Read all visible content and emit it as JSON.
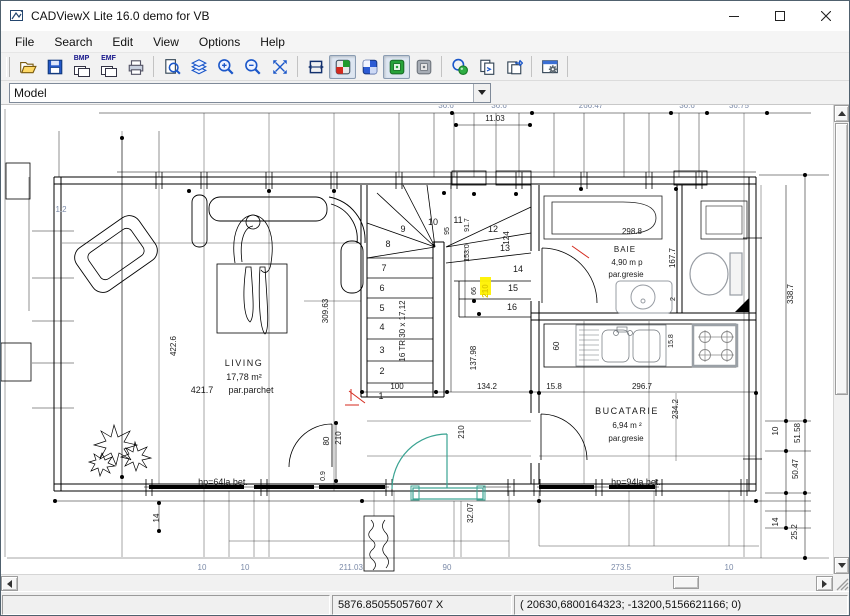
{
  "window": {
    "title": "CADViewX Lite 16.0 demo for VB"
  },
  "menu": {
    "items": [
      "File",
      "Search",
      "Edit",
      "View",
      "Options",
      "Help"
    ]
  },
  "toolbar": {
    "bmp_label": "BMP",
    "emf_label": "EMF"
  },
  "layout_combo": {
    "value": "Model"
  },
  "statusbar": {
    "cursor_x": "5876.85055057607 X",
    "coordinates": "( 20630,6800164323; -13200,5156621166; 0)"
  },
  "drawing": {
    "colors": {
      "selection_teal": "#3aa392",
      "highlight_yellow": "#fff200",
      "mark_red": "#d42a1e",
      "dim_gray_blue": "#7b8aa8"
    },
    "labels": [
      {
        "t": "LIVING",
        "x": 245,
        "y": 365,
        "s": 9,
        "sp": 1.5
      },
      {
        "t": "17,78 m²",
        "x": 245,
        "y": 379,
        "s": 9
      },
      {
        "t": "par.parchet",
        "x": 252,
        "y": 392,
        "s": 9
      },
      {
        "t": "421.7",
        "x": 203,
        "y": 392,
        "s": 9
      },
      {
        "t": "BAIE",
        "x": 626,
        "y": 251,
        "s": 8,
        "sp": 1
      },
      {
        "t": "4,90 m p",
        "x": 628,
        "y": 264,
        "s": 8
      },
      {
        "t": "par.gresie",
        "x": 627,
        "y": 276,
        "s": 8
      },
      {
        "t": "298.8",
        "x": 633,
        "y": 233,
        "s": 8
      },
      {
        "t": "BUCATARIE",
        "x": 628,
        "y": 413,
        "s": 9,
        "sp": 1.5
      },
      {
        "t": "6,94 m ²",
        "x": 628,
        "y": 427,
        "s": 8
      },
      {
        "t": "par.gresie",
        "x": 627,
        "y": 440,
        "s": 8
      },
      {
        "t": "hp=64la bet.",
        "x": 224,
        "y": 484,
        "s": 9
      },
      {
        "t": "hp=94la bet.",
        "x": 637,
        "y": 484,
        "s": 9
      },
      {
        "t": "100",
        "x": 398,
        "y": 388,
        "s": 8
      },
      {
        "t": "134.2",
        "x": 488,
        "y": 388,
        "s": 8
      },
      {
        "t": "15.8",
        "x": 555,
        "y": 388,
        "s": 8
      },
      {
        "t": "296.7",
        "x": 643,
        "y": 388,
        "s": 8
      },
      {
        "t": "11.03",
        "x": 496,
        "y": 120,
        "s": 8
      },
      {
        "t": "422.6",
        "x": 177,
        "y": 345,
        "r": 1,
        "s": 8
      },
      {
        "t": "309.63",
        "x": 329,
        "y": 310,
        "r": 1,
        "s": 8
      },
      {
        "t": "16 TR.30 x 17,12",
        "x": 406,
        "y": 330,
        "r": 1,
        "s": 8
      },
      {
        "t": "137.98",
        "x": 477,
        "y": 357,
        "r": 1,
        "s": 8
      },
      {
        "t": "66",
        "x": 477,
        "y": 290,
        "r": 1,
        "s": 7
      },
      {
        "t": "210",
        "x": 489,
        "y": 290,
        "r": 1,
        "s": 8,
        "c": "#e0cc00",
        "b": 1
      },
      {
        "t": "95",
        "x": 450,
        "y": 230,
        "r": 1,
        "s": 7
      },
      {
        "t": "91.7",
        "x": 470,
        "y": 224,
        "r": 1,
        "s": 7
      },
      {
        "t": "153.0",
        "x": 470,
        "y": 252,
        "r": 1,
        "s": 7
      },
      {
        "t": "124",
        "x": 510,
        "y": 237,
        "r": 1,
        "s": 8
      },
      {
        "t": "167.7",
        "x": 676,
        "y": 257,
        "r": 1,
        "s": 8
      },
      {
        "t": "2",
        "x": 676,
        "y": 298,
        "r": 1,
        "s": 7
      },
      {
        "t": "60",
        "x": 560,
        "y": 345,
        "r": 1,
        "s": 8
      },
      {
        "t": "15.8",
        "x": 674,
        "y": 340,
        "r": 1,
        "s": 7
      },
      {
        "t": "234.2",
        "x": 679,
        "y": 408,
        "r": 1,
        "s": 8
      },
      {
        "t": "338.7",
        "x": 794,
        "y": 293,
        "r": 1,
        "s": 8
      },
      {
        "t": "10",
        "x": 779,
        "y": 430,
        "r": 1,
        "s": 8
      },
      {
        "t": "51.58",
        "x": 801,
        "y": 432,
        "r": 1,
        "s": 8
      },
      {
        "t": "50.47",
        "x": 799,
        "y": 468,
        "r": 1,
        "s": 8
      },
      {
        "t": "14",
        "x": 779,
        "y": 521,
        "r": 1,
        "s": 8
      },
      {
        "t": "25.2",
        "x": 798,
        "y": 531,
        "r": 1,
        "s": 8
      },
      {
        "t": "80",
        "x": 330,
        "y": 440,
        "r": 1,
        "s": 8
      },
      {
        "t": "210",
        "x": 342,
        "y": 437,
        "r": 1,
        "s": 8
      },
      {
        "t": "0.9",
        "x": 326,
        "y": 475,
        "r": 1,
        "s": 7
      },
      {
        "t": "14",
        "x": 160,
        "y": 517,
        "r": 1,
        "s": 8
      },
      {
        "t": "210",
        "x": 465,
        "y": 431,
        "r": 1,
        "s": 8
      },
      {
        "t": "32.07",
        "x": 474,
        "y": 512,
        "r": 1,
        "s": 8
      },
      {
        "t": "1.2",
        "x": 62,
        "y": 211,
        "s": 8,
        "c": "#7b8aa8"
      },
      {
        "t": "36.6",
        "x": 447,
        "y": 107,
        "s": 8,
        "c": "#7b8aa8"
      },
      {
        "t": "36.6",
        "x": 500,
        "y": 107,
        "s": 8,
        "c": "#7b8aa8"
      },
      {
        "t": "266.47",
        "x": 592,
        "y": 107,
        "s": 8,
        "c": "#7b8aa8"
      },
      {
        "t": "36.6",
        "x": 688,
        "y": 107,
        "s": 8,
        "c": "#7b8aa8"
      },
      {
        "t": "36.75",
        "x": 740,
        "y": 107,
        "s": 8,
        "c": "#7b8aa8"
      },
      {
        "t": "10",
        "x": 203,
        "y": 569,
        "s": 8,
        "c": "#7b8aa8"
      },
      {
        "t": "10",
        "x": 246,
        "y": 569,
        "s": 8,
        "c": "#7b8aa8"
      },
      {
        "t": "211.03",
        "x": 352,
        "y": 569,
        "s": 8,
        "c": "#7b8aa8"
      },
      {
        "t": "90",
        "x": 448,
        "y": 569,
        "s": 8,
        "c": "#7b8aa8"
      },
      {
        "t": "273.5",
        "x": 622,
        "y": 569,
        "s": 8,
        "c": "#7b8aa8"
      },
      {
        "t": "10",
        "x": 730,
        "y": 569,
        "s": 8,
        "c": "#7b8aa8"
      }
    ],
    "stair_numbers": [
      {
        "n": "1",
        "x": 382,
        "y": 398
      },
      {
        "n": "2",
        "x": 383,
        "y": 373
      },
      {
        "n": "3",
        "x": 383,
        "y": 352
      },
      {
        "n": "4",
        "x": 383,
        "y": 329
      },
      {
        "n": "5",
        "x": 383,
        "y": 310
      },
      {
        "n": "6",
        "x": 383,
        "y": 290
      },
      {
        "n": "7",
        "x": 385,
        "y": 270
      },
      {
        "n": "8",
        "x": 389,
        "y": 246
      },
      {
        "n": "9",
        "x": 404,
        "y": 231
      },
      {
        "n": "10",
        "x": 434,
        "y": 224
      },
      {
        "n": "11",
        "x": 459,
        "y": 222
      },
      {
        "n": "12",
        "x": 494,
        "y": 231
      },
      {
        "n": "13",
        "x": 506,
        "y": 250
      },
      {
        "n": "14",
        "x": 519,
        "y": 271
      },
      {
        "n": "15",
        "x": 514,
        "y": 290
      },
      {
        "n": "16",
        "x": 513,
        "y": 309
      }
    ]
  }
}
